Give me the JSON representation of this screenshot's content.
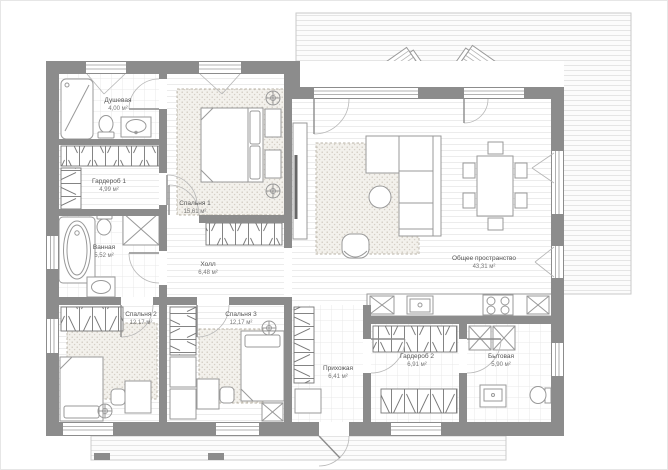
{
  "plan": {
    "units": "м²",
    "rooms": {
      "shower": {
        "name": "Душевая",
        "area": "4,00 м²"
      },
      "wardrobe1": {
        "name": "Гардероб 1",
        "area": "4,99 м²"
      },
      "bedroom1": {
        "name": "Спальня 1",
        "area": "15,61 м²"
      },
      "bathroom": {
        "name": "Ванная",
        "area": "5,52 м²"
      },
      "hall": {
        "name": "Холл",
        "area": "6,48 м²"
      },
      "common": {
        "name": "Общее пространство",
        "area": "43,31 м²"
      },
      "bedroom2": {
        "name": "Спальня 2",
        "area": "12,17 м²"
      },
      "bedroom3": {
        "name": "Спальня 3",
        "area": "12,17 м²"
      },
      "entry": {
        "name": "Прихожая",
        "area": "6,41 м²"
      },
      "wardrobe2": {
        "name": "Гардероб 2",
        "area": "6,91 м²"
      },
      "utility": {
        "name": "Бытовая",
        "area": "5,90 м²"
      }
    },
    "colors": {
      "wall": "#8c8c8c",
      "fixture_line": "#999999",
      "label_text": "#555555",
      "carpet": "#f3f1ec"
    }
  }
}
